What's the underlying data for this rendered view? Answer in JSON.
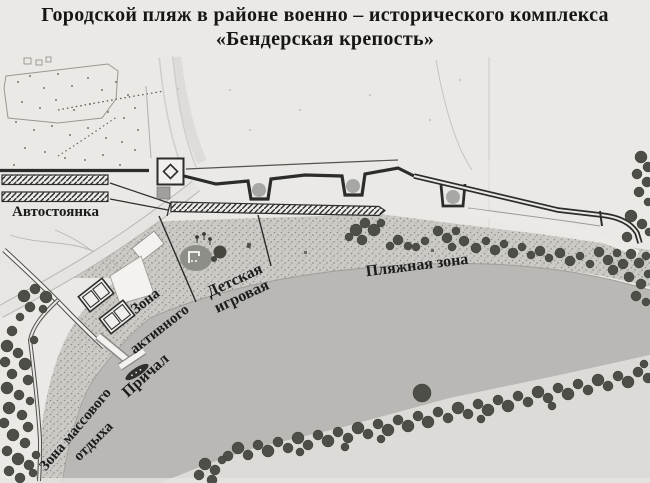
{
  "title": {
    "line1": "Городской пляж в районе военно – исторического комплекса",
    "line2": "«Бендерская крепость»"
  },
  "labels": {
    "parking": "Автостоянка",
    "active_zone_line1": "Зона",
    "active_zone_line2": "активного",
    "children_zone_line1": "Детская",
    "children_zone_line2": "игровая",
    "beach_zone": "Пляжная зона",
    "pier": "Причал",
    "mass_rest_line1": "Зона массового",
    "mass_rest_line2": "отдыха"
  },
  "colors": {
    "paper": "#eae9e5",
    "water": "#b9b8b4",
    "beach_stipple_base": "#cbcac6",
    "far_bank": "#dcdbd7",
    "tree": "#4e4e48",
    "ink": "#2c2c29",
    "label_text": "#1c1c1a",
    "bastion_circle": "#a7a7a3"
  }
}
